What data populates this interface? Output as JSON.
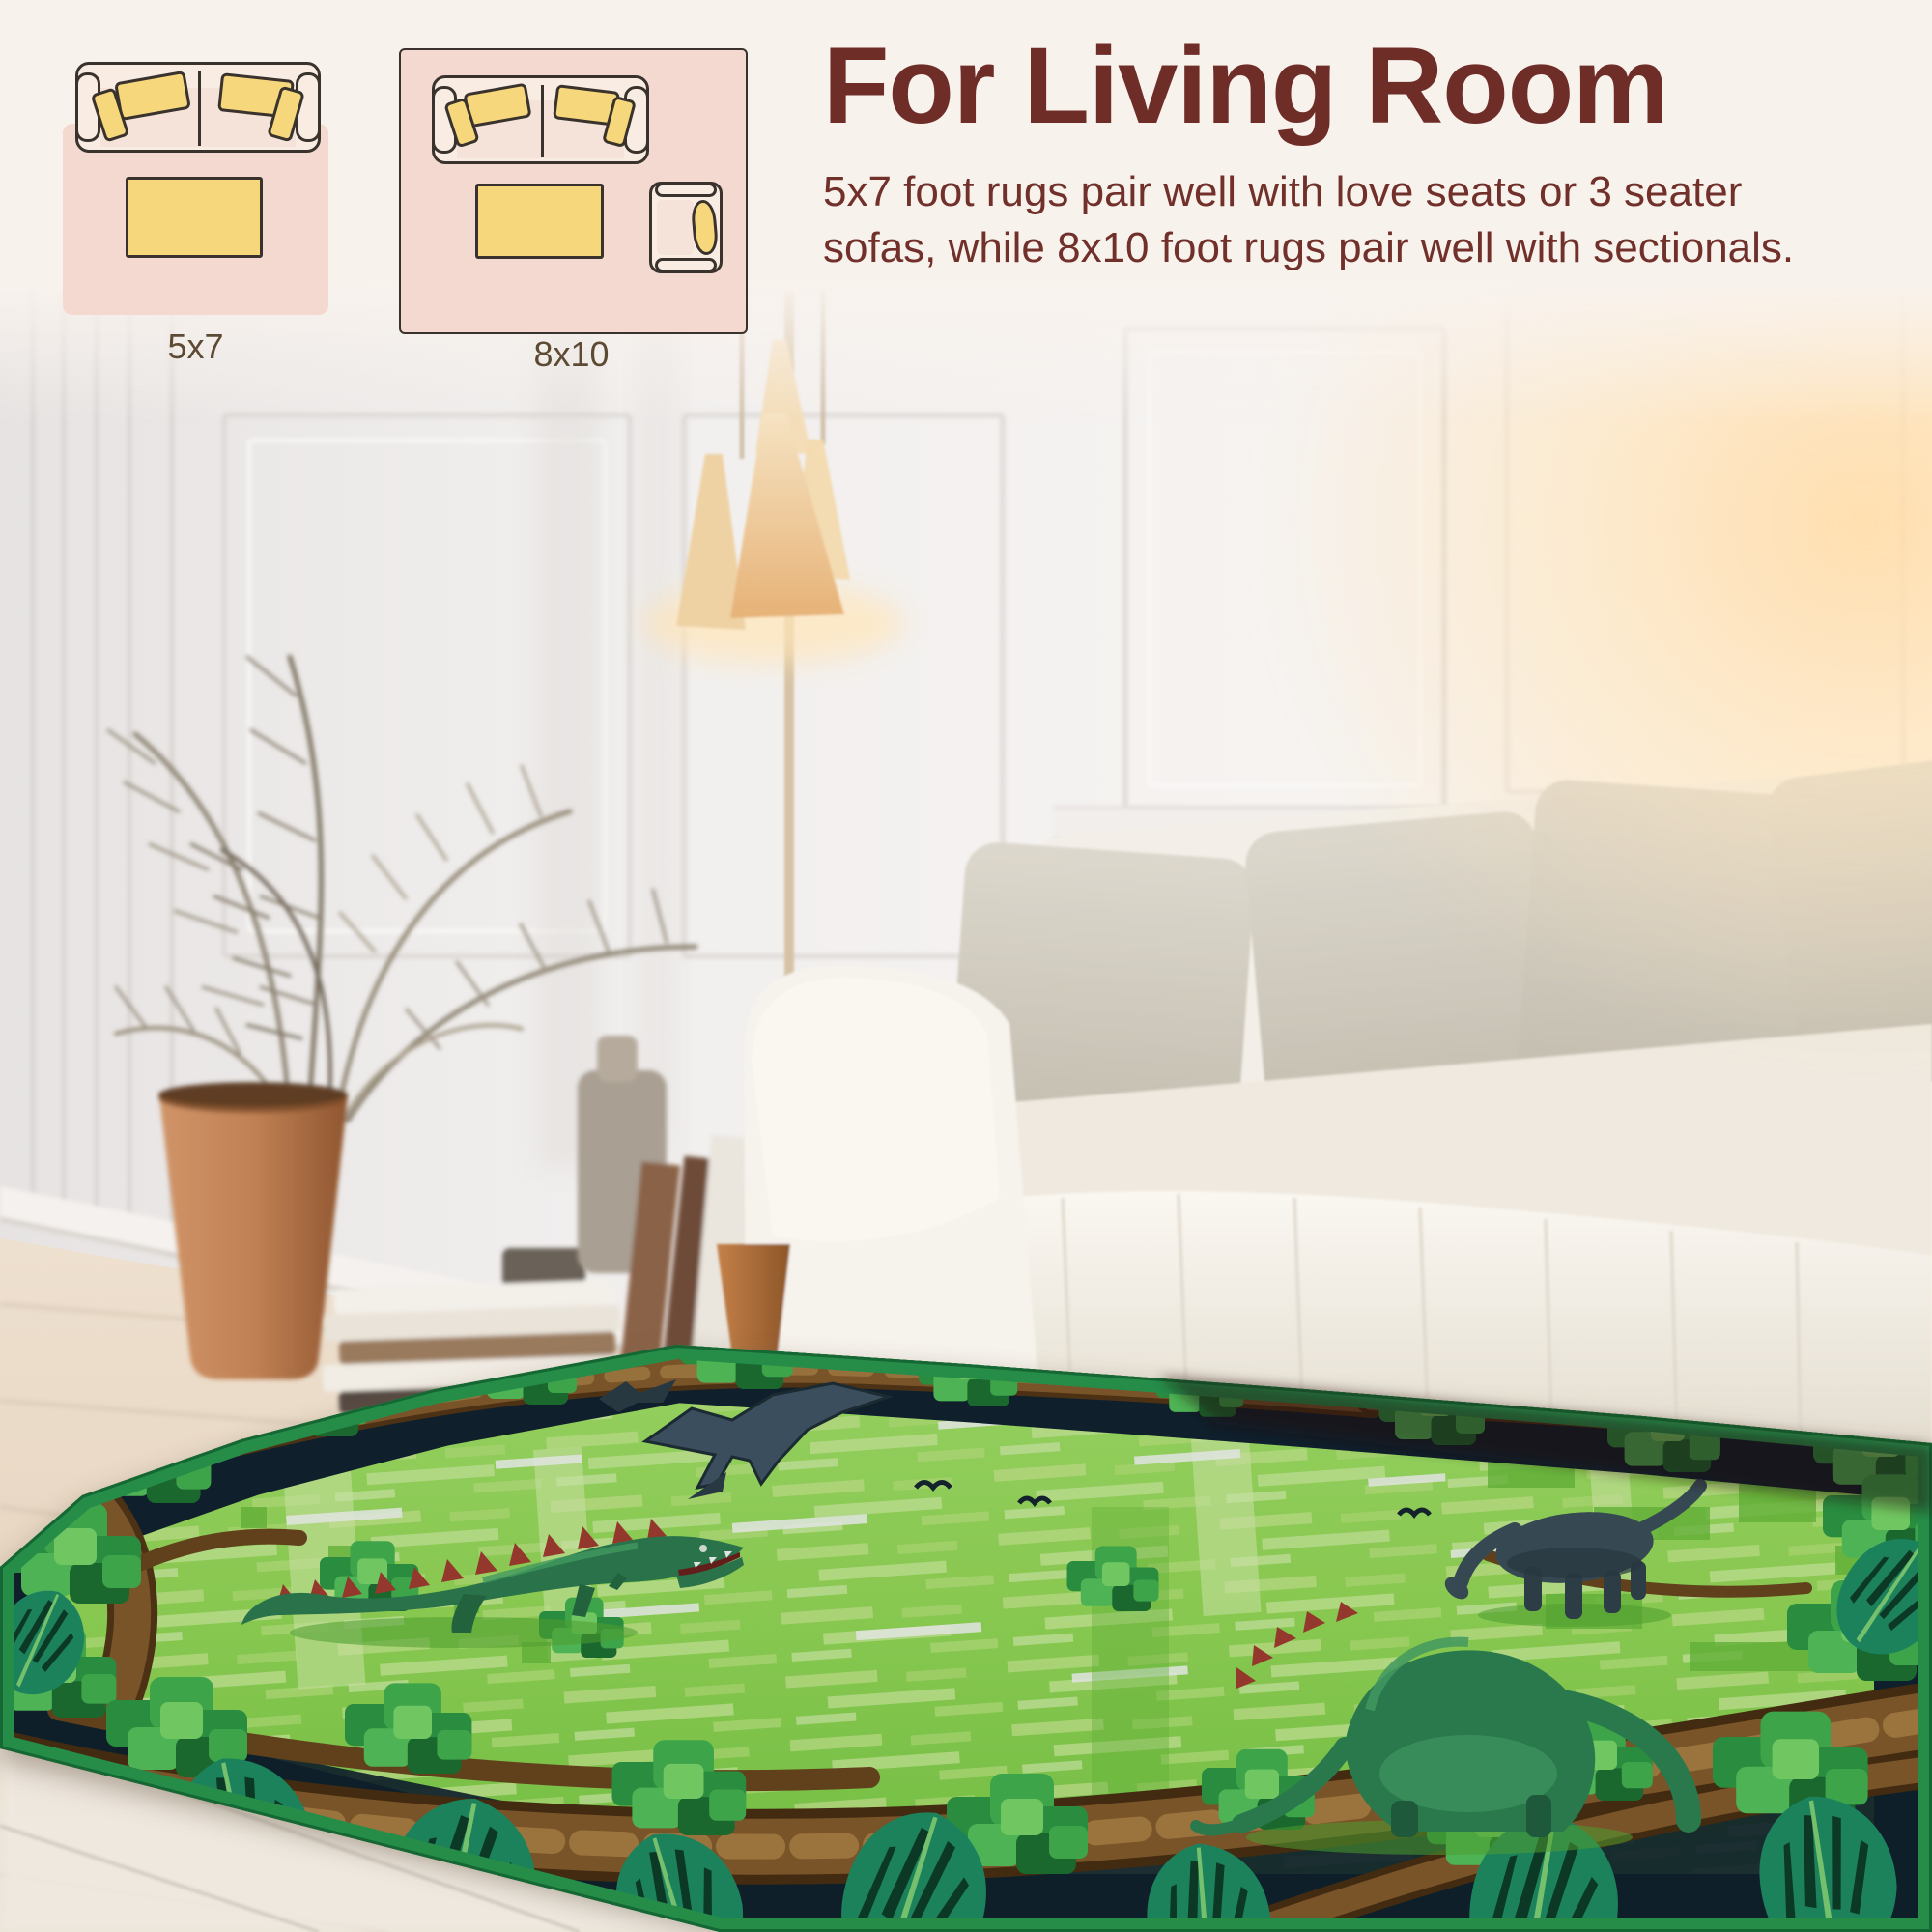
{
  "banner": {
    "title": "For Living Room",
    "description": "5x7 foot rugs pair well with love seats or 3 seater\nsofas, while 8x10 foot rugs pair well with sectionals.",
    "text_color": "#6f2d27",
    "background_color": "#f8f2ed"
  },
  "size_guide": {
    "small_rug": {
      "label": "5x7"
    },
    "large_rug": {
      "label": "8x10"
    },
    "label_color": "#5d4a33",
    "diagram_rug_fill": "#f3d9cf",
    "diagram_sofa_fill": "#f8ece3",
    "diagram_pillow_fill": "#f6d77c",
    "diagram_outline": "#3a332d"
  },
  "photo": {
    "rug_theme_colors": {
      "field_green": "#9ade5b",
      "bind_green": "#2b9b53",
      "border_navy": "#101e30",
      "branch_brown": "#8a5a2e",
      "leaf_green": "#3aa94f",
      "monstera_teal": "#1f8f68",
      "dino_green": "#2f7d52",
      "dino_slate": "#3d4d5c",
      "spine_red": "#a83a31"
    }
  }
}
